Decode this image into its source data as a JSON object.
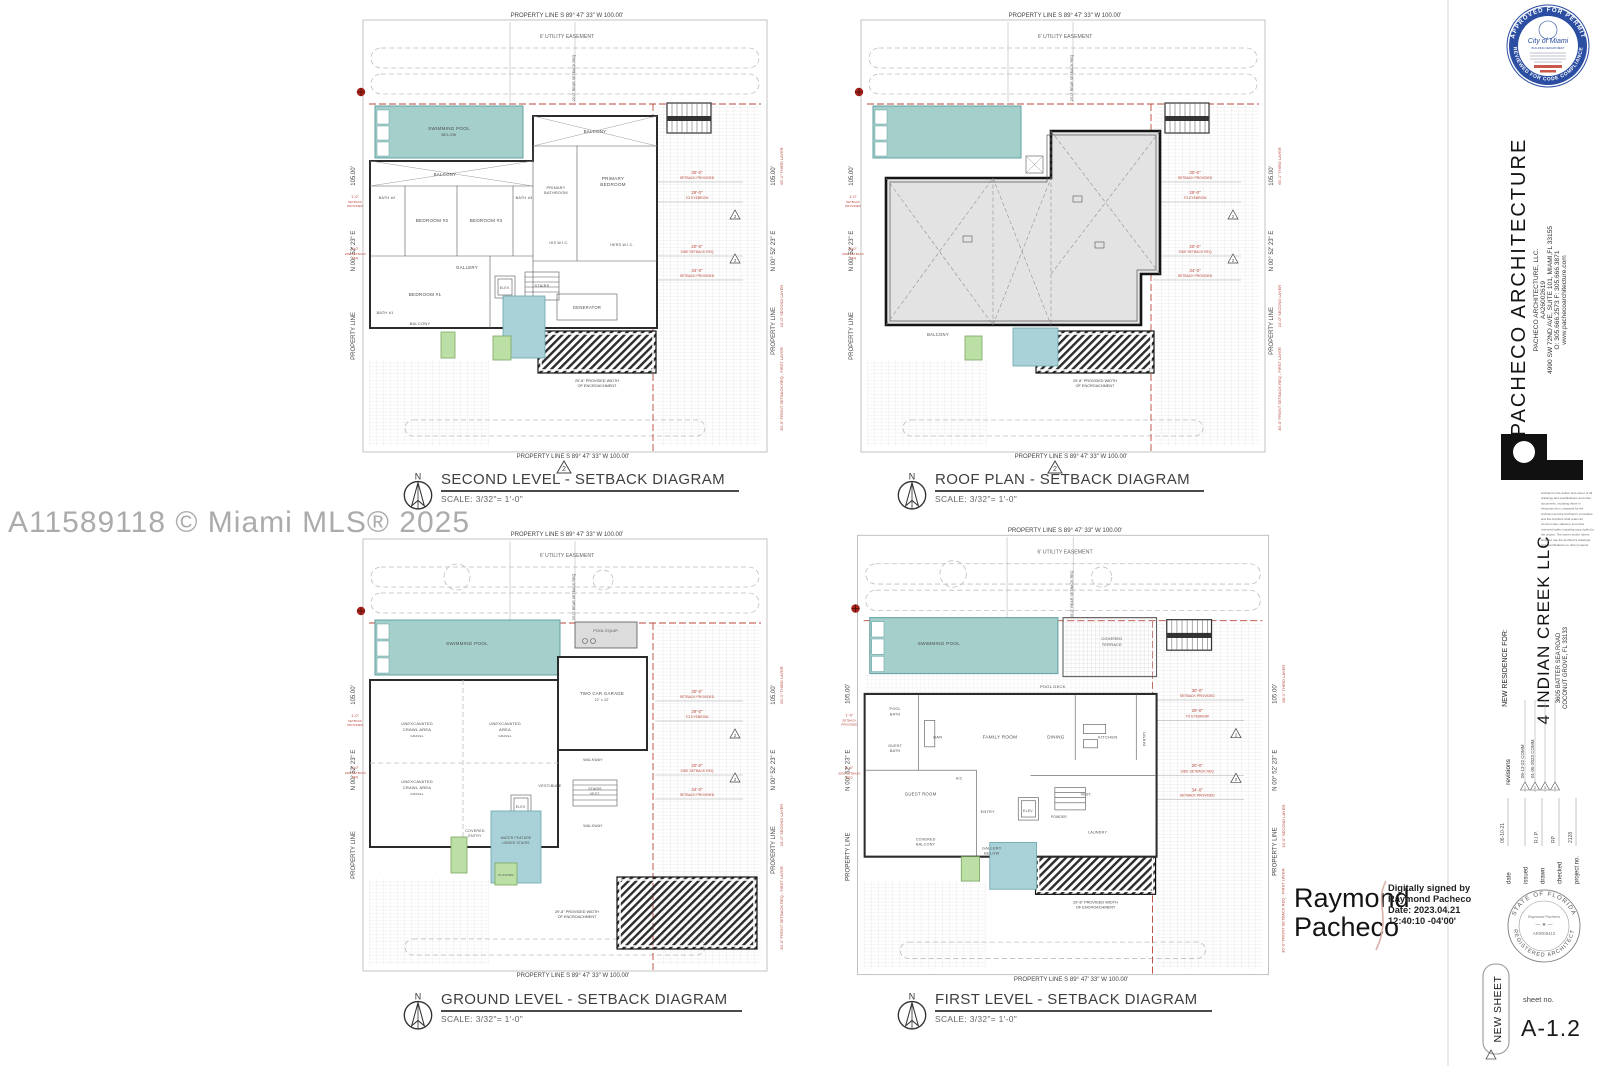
{
  "watermark": "A11589118 © Miami MLS® 2025",
  "north_letter": "N",
  "frame": {
    "property_line_top": "PROPERTY LINE      S  89° 47' 33\"  W      100.00'",
    "utility_easement": "6' UTILITY EASEMENT",
    "property_line_bottom": "PROPERTY LINE      S  89° 47' 33\"  W      100.00'",
    "side_length": "105.00'",
    "side_bearing": "N  00° 52' 23\"  E",
    "property_line_side": "PROPERTY LINE",
    "dim_30": "30'-0\"",
    "dim_30_sub": "SETBACK PROVIDED",
    "dim_29": "29'-0\"",
    "dim_29_sub": "TO EYEBROW",
    "dim_20": "20'-0\"",
    "dim_20_sub": "SIDE SETBACK REQ",
    "dim_34": "34'-0\"",
    "dim_34_sub": "SETBACK PROVIDED",
    "red_third_layer": "65'-1\"  THIRD LAYER",
    "red_second_layer": "10'-0\"  SECOND LAYER",
    "red_front_setback": "30'-0\"  FRONT SETBACK REQ - FIRST LAYER",
    "rear_setback": "20'-0\" REAR SETBACK REQ",
    "left_dim1": "1'-0\"",
    "left_dim1_sub1": "SETBACK",
    "left_dim1_sub2": "PROVIDED",
    "left_dim2": "5'-0\"",
    "left_dim2_sub1": "SIDE SETBACK",
    "left_dim2_sub2": "REQ",
    "encroachment_1": "29'-8\" PROVIDED WIDTH",
    "encroachment_2": "OF ENCROACHMENT",
    "rev_triangle": "2"
  },
  "plans": {
    "second_level": {
      "title": "SECOND LEVEL - SETBACK DIAGRAM",
      "scale": "SCALE: 3/32\"= 1'-0\"",
      "rooms": {
        "pool_1": "SWIMMING POOL",
        "pool_2": "BELOW",
        "balcony_top": "BALCONY",
        "balcony_right": "BALCONY",
        "balcony_bottom": "BALCONY",
        "bath2": "BATH #2",
        "bedroom2": "BEDROOM #2",
        "bedroom3": "BEDROOM #3",
        "bath3": "BATH #3",
        "primary_bath_1": "PRIMARY",
        "primary_bath_2": "BATHROOM",
        "primary_bed_1": "PRIMARY",
        "primary_bed_2": "BEDROOM",
        "his_wic": "HIS W.I.C.",
        "hers_wic": "HERS W.I.C.",
        "gallery": "GALLERY",
        "bedroom1": "BEDROOM #1",
        "bath1": "BATH #1",
        "elev": "ELEV.",
        "stairs": "STAIRS",
        "generator": "GENERATOR"
      }
    },
    "roof_plan": {
      "title": "ROOF PLAN - SETBACK DIAGRAM",
      "scale": "SCALE: 3/32\"= 1'-0\"",
      "rooms": {
        "balcony": "BALCONY"
      }
    },
    "ground_level": {
      "title": "GROUND LEVEL - SETBACK DIAGRAM",
      "scale": "SCALE: 3/32\"= 1'-0\"",
      "rooms": {
        "pool": "SWIMMING POOL",
        "pool_equip": "POOL EQUIP.",
        "garage_1": "TWO CAR GARAGE",
        "garage_2": "22' x 22'",
        "unexc1_1": "UNEXCAVATED",
        "unexc1_2": "CRAWL AREA",
        "unexc1_3": "GRAVEL",
        "unexc2_1": "UNEXCAVATED",
        "unexc2_2": "AREA",
        "unexc2_3": "GRAVEL",
        "unexc3_1": "UNEXCAVATED",
        "unexc3_2": "CRAWL AREA",
        "unexc3_3": "GRAVEL",
        "vestibule": "VESTIBULE",
        "elev": "ELEV.",
        "stairs_vest_1": "STAIRS",
        "stairs_vest_2": "VEST.",
        "walkway_r": "WALKWAY",
        "walkway_b": "WALKWAY",
        "covered_entry_1": "COVERED",
        "covered_entry_2": "ENTRY",
        "water_1": "WATER FEATURE",
        "water_2": "UNDER STAIRS",
        "planter": "PLANTER"
      }
    },
    "first_level": {
      "title": "FIRST LEVEL - SETBACK DIAGRAM",
      "scale": "SCALE: 3/32\"= 1'-0\"",
      "rooms": {
        "pool": "SWIMMING POOL",
        "terrace_1": "COVERED",
        "terrace_2": "TERRACE",
        "pool_deck": "POOL DECK",
        "pool_bath_1": "POOL",
        "pool_bath_2": "BATH",
        "guest_bath_1": "GUEST",
        "guest_bath_2": "BATH",
        "bar": "BAR",
        "family": "FAMILY ROOM",
        "dining": "DINING",
        "kitchen": "KITCHEN",
        "pantry": "PANTRY",
        "guest_room": "GUEST ROOM",
        "ac": "A/C",
        "entry": "ENTRY",
        "elev": "ELEV.",
        "powder": "POWDER",
        "vest": "VEST.",
        "laundry": "LAUNDRY",
        "cov_balcony_1": "COVERED",
        "cov_balcony_2": "BALCONY",
        "gallery_1": "GALLERY",
        "gallery_2": "BELOW"
      }
    }
  },
  "titleblock": {
    "firm_name": "PACHECO ARCHITECTURE",
    "firm_lines": [
      "PACHECO ARCHITECTURE, LLC.",
      "AA26002619",
      "4990 SW 72ND AVE, SUITE 101, MIAMI,FL 33155",
      "O: 305.666.2573   F: 305.666.3871",
      "www.pachecoarchitecture.com"
    ],
    "disclaimer_lines": [
      "Architect is the author and owner of all",
      "drawings and specifications and other",
      "documents,  including  those  in",
      "electronic form, prepared by the",
      "Architect and the Architect's consultant",
      "and the Architect shall retain all",
      "common law, statutory and other",
      "reserved rights, including copy rights for",
      "the project.  The owner and/or others",
      "shall not use the Architect's drawings",
      "and specifications on other projects."
    ],
    "for_label": "NEW RESIDENCE FOR:",
    "client": "4 INDIAN CREEK LLC",
    "address": [
      "3605 BATTER SEA ROAD",
      "COCONUT GROVE, FL 33133"
    ],
    "revisions_label": "revisions",
    "revisions": [
      {
        "no": "1",
        "text": "05-13-22 COMM"
      },
      {
        "no": "2",
        "text": "01-05-2023 COMM"
      },
      {
        "no": "3",
        "text": ""
      },
      {
        "no": "4",
        "text": ""
      }
    ],
    "fields": [
      {
        "label": "date",
        "value": "06-10-21"
      },
      {
        "label": "issued",
        "value": ""
      },
      {
        "label": "drawn",
        "value": "R.I.P."
      },
      {
        "label": "checked",
        "value": "RP"
      },
      {
        "label": "project no.",
        "value": "2128"
      }
    ],
    "miami_seal": {
      "arc_top": "APPROVED FOR PERMIT",
      "arc_bottom": "REVIEWED FOR CODE COMPLIANCE",
      "city": "City of Miami",
      "dept": "BUILDING DEPARTMENT"
    },
    "signature": {
      "line1": "Raymond",
      "line2": "Pacheco",
      "note_lines": [
        "Digitally signed by",
        "Raymond Pacheco",
        "Date: 2023.04.21",
        "12:40:10 -04'00'"
      ]
    },
    "fl_seal": {
      "arc_top": "STATE OF FLORIDA",
      "arc_bottom": "REGISTERED ARCHITECT",
      "name": "Raymond Pacheco",
      "license": "AR0006413"
    },
    "new_sheet": "NEW SHEET",
    "sheet_no_label": "sheet no.",
    "sheet_no": "A-1.2"
  }
}
